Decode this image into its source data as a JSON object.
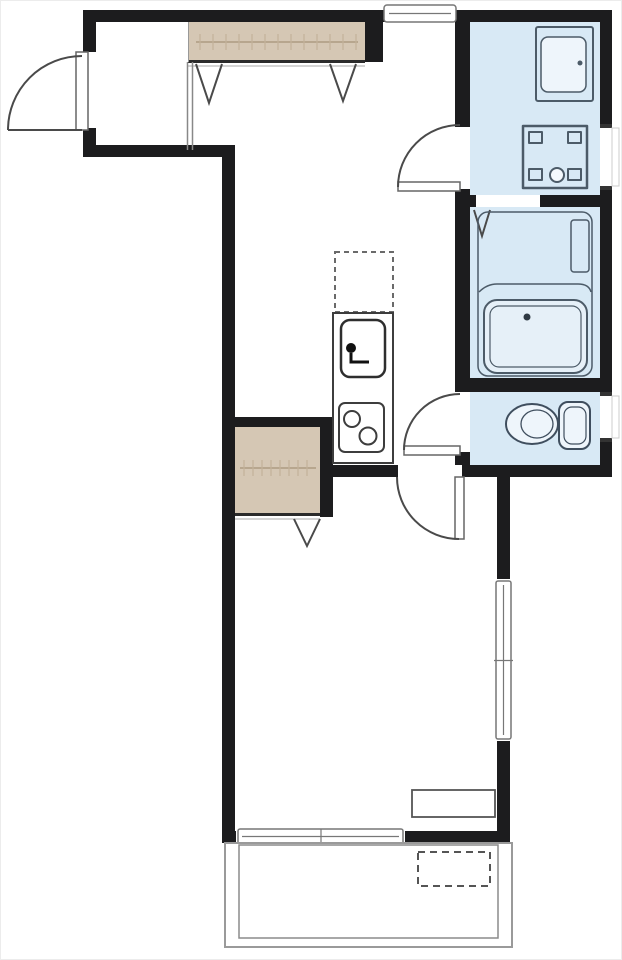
{
  "plan": {
    "type": "floor-plan",
    "label": "apartment floor plan",
    "rooms": [
      {
        "name": "entry-hall"
      },
      {
        "name": "corridor-kitchen"
      },
      {
        "name": "washroom"
      },
      {
        "name": "bathroom"
      },
      {
        "name": "toilet-room"
      },
      {
        "name": "main-room"
      },
      {
        "name": "balcony"
      },
      {
        "name": "closet-upper"
      },
      {
        "name": "closet-lower"
      }
    ],
    "fixtures": [
      "entrance-door",
      "washbasin-vanity",
      "washing-machine-pan",
      "bathtub",
      "toilet",
      "refrigerator-space",
      "kitchen-sink",
      "gas-stove",
      "storage-counter",
      "sliding-window",
      "balcony-equipment-space"
    ],
    "door_count": 4,
    "folding_door_marks": 4,
    "window_count": 5
  },
  "colors": {
    "background": "#ffffff",
    "wall": "#1c1c1e",
    "wet_room_fill": "#d8e9f5",
    "closet_fill": "#d5c7b4",
    "fixture_stroke": "#4c5b68",
    "door_line": "#4a4a4a",
    "window_frame": "#777777"
  }
}
